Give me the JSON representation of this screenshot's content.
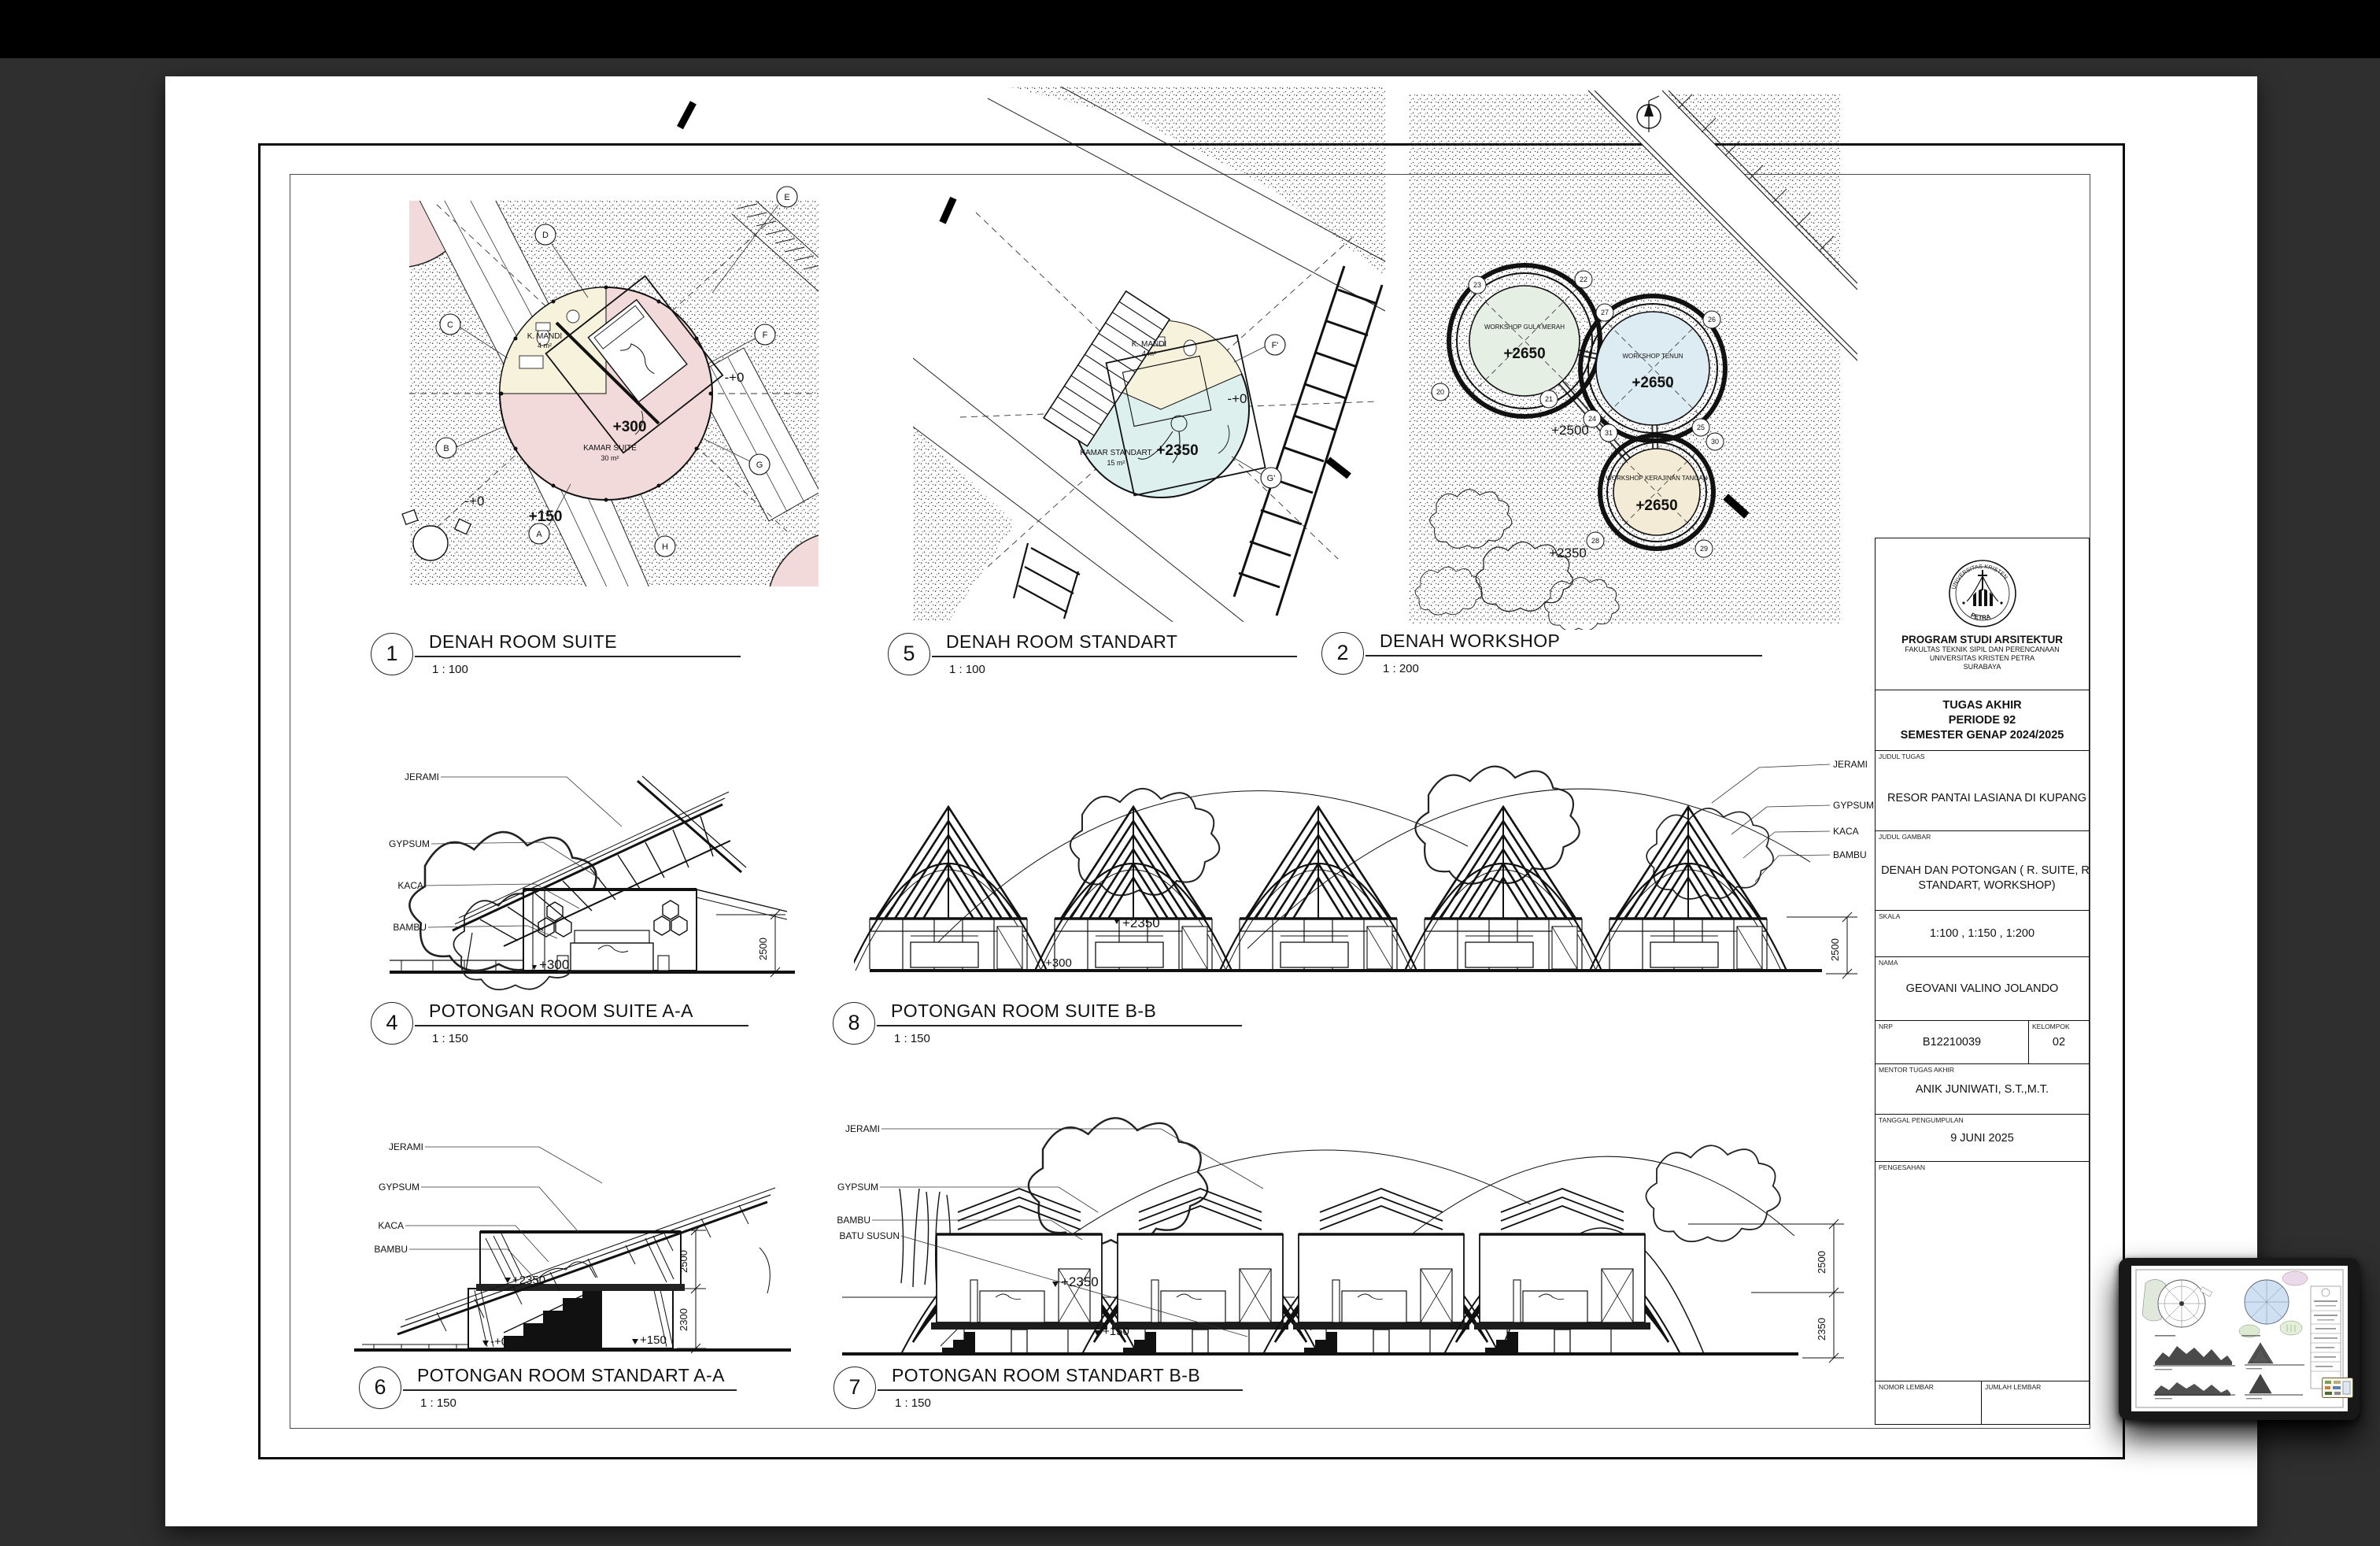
{
  "app": {
    "background_color": "#2f2f2f",
    "topbar_color": "#000000",
    "paper_color": "#ffffff"
  },
  "drawings": [
    {
      "id": "denah-room-suite",
      "number": "1",
      "title": "DENAH ROOM SUITE",
      "scale": "1 : 100",
      "labels": {
        "bath": "K. MANDI",
        "bath_area": "4 m²",
        "elev": "+300",
        "room": "KAMAR SUITE",
        "room_area": "30 m²",
        "path_elev": "+150",
        "ground_elev": "-+0",
        "ground_elev2": "-+0"
      },
      "grid_bubbles": [
        "D",
        "E",
        "C",
        "B",
        "A",
        "F",
        "G",
        "H"
      ],
      "fill_color": "#f3dada",
      "bath_color": "#f7f2dc"
    },
    {
      "id": "denah-room-standart",
      "number": "5",
      "title": "DENAH ROOM STANDART",
      "scale": "1 : 100",
      "labels": {
        "bath": "K. MANDI",
        "bath_area": "4 m²",
        "ground_elev": "-+0",
        "room": "KAMAR STANDART",
        "room_area": "15 m²",
        "elev": "+2350"
      },
      "grid_bubbles": [
        "F'",
        "G'"
      ],
      "fill_color": "#def0ee",
      "bath_color": "#f7f2dc"
    },
    {
      "id": "denah-workshop",
      "number": "2",
      "title": "DENAH WORKSHOP",
      "scale": "1 : 200",
      "circles": [
        {
          "name": "WORKSHOP GULA MERAH",
          "elev": "+2650",
          "fill": "#e5efe3"
        },
        {
          "name": "WORKSHOP TENUN",
          "elev": "+2650",
          "fill": "#dcecf2"
        },
        {
          "name": "WORKSHOP KERAJINAN TANGAN",
          "elev": "+2650",
          "fill": "#f4ebd7"
        }
      ],
      "ground1": "+2500",
      "ground2": "+2350",
      "tree_numbers": [
        "20",
        "21",
        "22",
        "23",
        "24",
        "25",
        "26",
        "27",
        "28",
        "29",
        "30",
        "31"
      ]
    },
    {
      "id": "potongan-room-suite-aa",
      "number": "4",
      "title": "POTONGAN ROOM SUITE A-A",
      "scale": "1 : 150",
      "material_labels": [
        "JERAMI",
        "GYPSUM",
        "KACA",
        "BAMBU"
      ],
      "elevations": [
        "+300"
      ],
      "dims": [
        "2500"
      ]
    },
    {
      "id": "potongan-room-suite-bb",
      "number": "8",
      "title": "POTONGAN ROOM SUITE B-B",
      "scale": "1 : 150",
      "material_labels": [
        "JERAMI",
        "GYPSUM",
        "KACA",
        "BAMBU"
      ],
      "elevations": [
        "+2350",
        "+300"
      ],
      "dims": [
        "2500"
      ]
    },
    {
      "id": "potongan-room-standart-aa",
      "number": "6",
      "title": "POTONGAN ROOM STANDART A-A",
      "scale": "1 : 150",
      "material_labels": [
        "JERAMI",
        "GYPSUM",
        "KACA",
        "BAMBU"
      ],
      "elevations": [
        "+2350",
        "-+0",
        "+150"
      ],
      "dims": [
        "2500",
        "2300"
      ]
    },
    {
      "id": "potongan-room-standart-bb",
      "number": "7",
      "title": "POTONGAN ROOM STANDART B-B",
      "scale": "1 : 150",
      "material_labels": [
        "JERAMI",
        "GYPSUM",
        "BAMBU",
        "BATU SUSUN"
      ],
      "elevations": [
        "+2350",
        "+150"
      ],
      "dims": [
        "2500",
        "2350"
      ]
    }
  ],
  "title_block": {
    "institution": {
      "program": "PROGRAM STUDI ARSITEKTUR",
      "faculty": "FAKULTAS TEKNIK SIPIL DAN PERENCANAAN",
      "university": "UNIVERSITAS KRISTEN PETRA",
      "city": "SURABAYA",
      "logo_top_text": "UNIVERSITAS KRISTEN",
      "logo_bottom_text": "PETRA"
    },
    "course_line1": "TUGAS AKHIR",
    "course_line2": "PERIODE 92",
    "course_line3": "SEMESTER GENAP 2024/2025",
    "judul_tugas": {
      "label": "JUDUL TUGAS",
      "value": "RESOR PANTAI LASIANA DI KUPANG"
    },
    "judul_gambar": {
      "label": "JUDUL GAMBAR",
      "value": "DENAH DAN POTONGAN ( R. SUITE, R. STANDART, WORKSHOP)"
    },
    "skala": {
      "label": "SKALA",
      "value": "1:100 , 1:150 , 1:200"
    },
    "nama": {
      "label": "NAMA",
      "value": "GEOVANI VALINO JOLANDO"
    },
    "nrp": {
      "label": "NRP",
      "value": "B12210039"
    },
    "kelompok": {
      "label": "KELOMPOK",
      "value": "02"
    },
    "mentor": {
      "label": "MENTOR TUGAS AKHIR",
      "value": "ANIK JUNIWATI, S.T.,M.T."
    },
    "tanggal": {
      "label": "TANGGAL PENGUMPULAN",
      "value": "9 JUNI 2025"
    },
    "pengesahan": {
      "label": "PENGESAHAN",
      "value": ""
    },
    "nomor_lembar": {
      "label": "NOMOR LEMBAR",
      "value": ""
    },
    "jumlah_lembar": {
      "label": "JUMLAH LEMBAR",
      "value": ""
    }
  }
}
